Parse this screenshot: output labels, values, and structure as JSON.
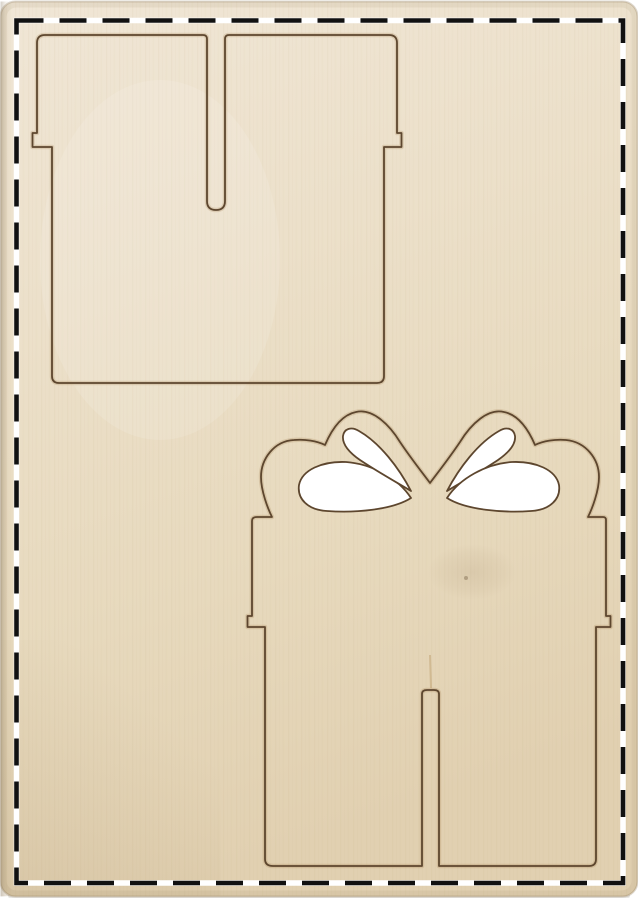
{
  "scene": {
    "kind": "product-photo",
    "subject": "laser-cut plywood craft sheet with two gift-box shaped cut lines and a dashed cutting border"
  },
  "palette": {
    "background": "#ffffff",
    "wood_top": "#efe5d4",
    "wood_mid": "#e9dcc3",
    "wood_bottom": "#e2d1b3",
    "wood_edge": "#c9b795",
    "cut_line": "#5d462e",
    "cut_burn": "rgba(150,108,60,0.20)",
    "cutout_fill": "#ffffff",
    "dash_color": "#111111",
    "dash_underlay": "#ffffff"
  },
  "border": {
    "style": "dashed",
    "dash_pattern": "27 16",
    "thickness_px": 5
  },
  "objects": {
    "panel": {
      "name": "plywood-sheet"
    },
    "shapes": [
      {
        "name": "gift-box-lid-piece",
        "position": "top-left",
        "features": [
          "open-slot-at-top",
          "side-lip-notches",
          "rounded-corners"
        ]
      },
      {
        "name": "gift-box-bow-piece",
        "position": "bottom-right",
        "features": [
          "double-loop-bow",
          "four-teardrop-cutouts",
          "side-lip-notches",
          "open-slot-at-bottom"
        ]
      }
    ],
    "cutouts_count": 4
  }
}
